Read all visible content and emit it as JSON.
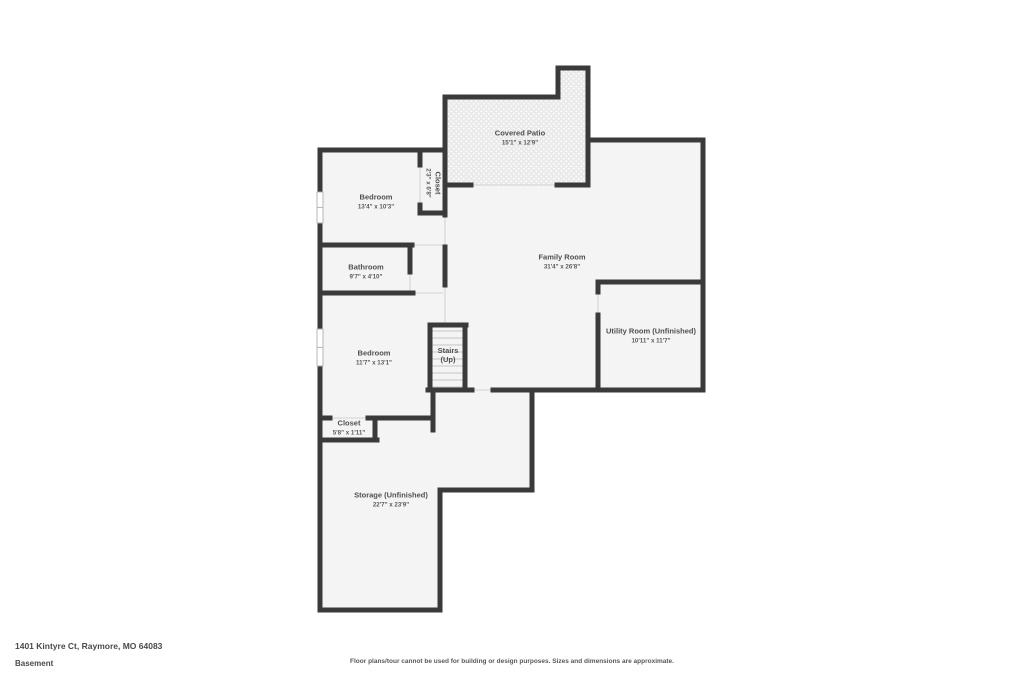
{
  "colors": {
    "walls": "#3a3a3a",
    "room_fill": "#f4f4f4",
    "patio_fill": "#eaeaea",
    "text": "#4f4f4f"
  },
  "rooms": {
    "covered_patio": {
      "name": "Covered Patio",
      "dims": "15'1\" x 12'9\""
    },
    "bedroom_top": {
      "name": "Bedroom",
      "dims": "13'4\" x 10'3\""
    },
    "closet_top": {
      "name": "Closet",
      "dims": "2'3\" x 6'8\""
    },
    "bathroom": {
      "name": "Bathroom",
      "dims": "9'7\" x 4'10\""
    },
    "family_room": {
      "name": "Family Room",
      "dims": "31'4\" x 26'8\""
    },
    "utility_room": {
      "name": "Utility Room (Unfinished)",
      "dims": "10'11\" x 11'7\""
    },
    "bedroom_lower": {
      "name": "Bedroom",
      "dims": "11'7\" x 13'1\""
    },
    "stairs": {
      "name": "Stairs",
      "line2": "(Up)"
    },
    "closet_lower": {
      "name": "Closet",
      "dims": "5'8\" x 1'11\""
    },
    "storage": {
      "name": "Storage (Unfinished)",
      "dims": "22'7\" x 23'9\""
    }
  },
  "footer": {
    "address": "1401 Kintyre Ct, Raymore, MO 64083",
    "floor_label": "Basement",
    "disclaimer": "Floor plans/tour cannot be used for building or design purposes. Sizes and dimensions are approximate."
  }
}
